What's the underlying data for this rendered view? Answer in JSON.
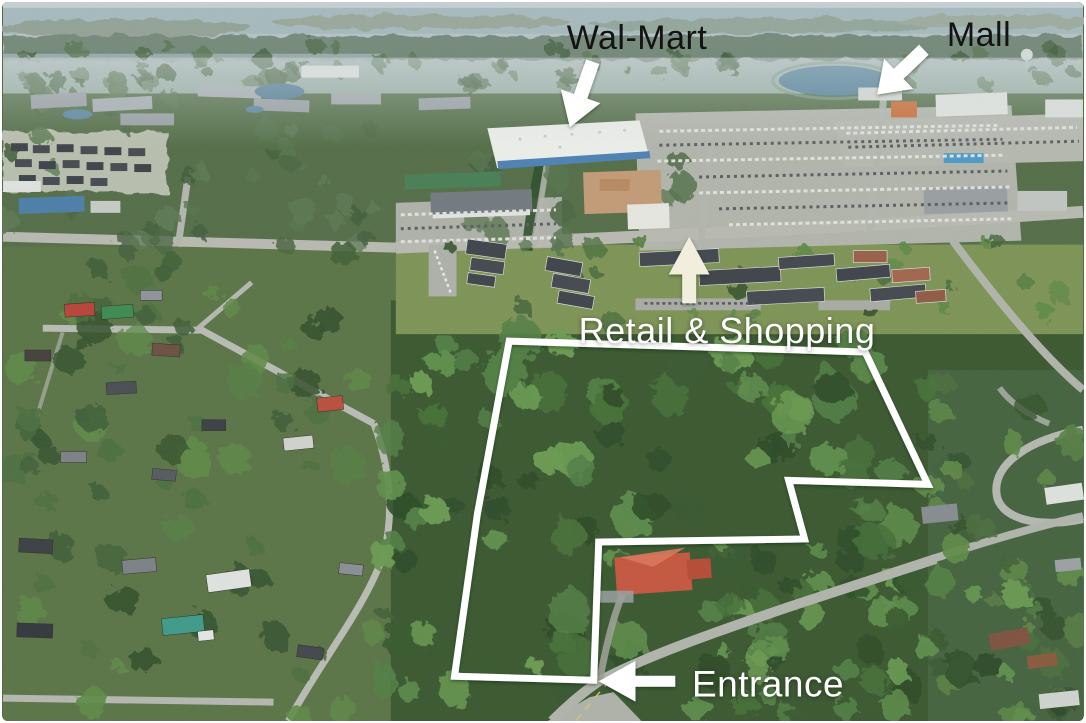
{
  "canvas": {
    "width": 1086,
    "height": 723
  },
  "colors": {
    "outline": "#ffffff",
    "label_dark": "#131313",
    "label_light": "#ffffff",
    "arrow_white": "#ffffff",
    "arrow_cream": "#f1eedd"
  },
  "labels": [
    {
      "id": "walmart",
      "text": "Wal-Mart",
      "tone": "dark",
      "x": 635,
      "y": 36,
      "size": 34
    },
    {
      "id": "mall",
      "text": "Mall",
      "tone": "dark",
      "x": 977,
      "y": 33,
      "size": 34
    },
    {
      "id": "retail",
      "text": "Retail & Shopping",
      "tone": "light",
      "x": 725,
      "y": 329,
      "size": 36
    },
    {
      "id": "entrance",
      "text": "Entrance",
      "tone": "light",
      "x": 766,
      "y": 682,
      "size": 37
    }
  ],
  "arrows": [
    {
      "id": "walmart-arrow",
      "tail": [
        593,
        60
      ],
      "tip": [
        570,
        126
      ],
      "shaft": 14,
      "head_w": 42,
      "head_l": 33,
      "fill": "white"
    },
    {
      "id": "mall-arrow",
      "tail": [
        926,
        48
      ],
      "tip": [
        879,
        93
      ],
      "shaft": 14,
      "head_w": 42,
      "head_l": 30,
      "fill": "white"
    },
    {
      "id": "retail-arrow",
      "tail": [
        690,
        303
      ],
      "tip": [
        690,
        236
      ],
      "shaft": 14,
      "head_w": 41,
      "head_l": 38,
      "fill": "cream"
    },
    {
      "id": "entrance-arrow",
      "tail": [
        676,
        683
      ],
      "tip": [
        599,
        683
      ],
      "shaft": 11,
      "head_w": 41,
      "head_l": 37,
      "fill": "white"
    }
  ],
  "property_outline": {
    "stroke_width": 7,
    "points": [
      [
        509,
        341
      ],
      [
        867,
        352
      ],
      [
        930,
        485
      ],
      [
        790,
        481
      ],
      [
        806,
        540
      ],
      [
        599,
        543
      ],
      [
        594,
        682
      ],
      [
        454,
        678
      ],
      [
        477,
        515
      ]
    ]
  }
}
